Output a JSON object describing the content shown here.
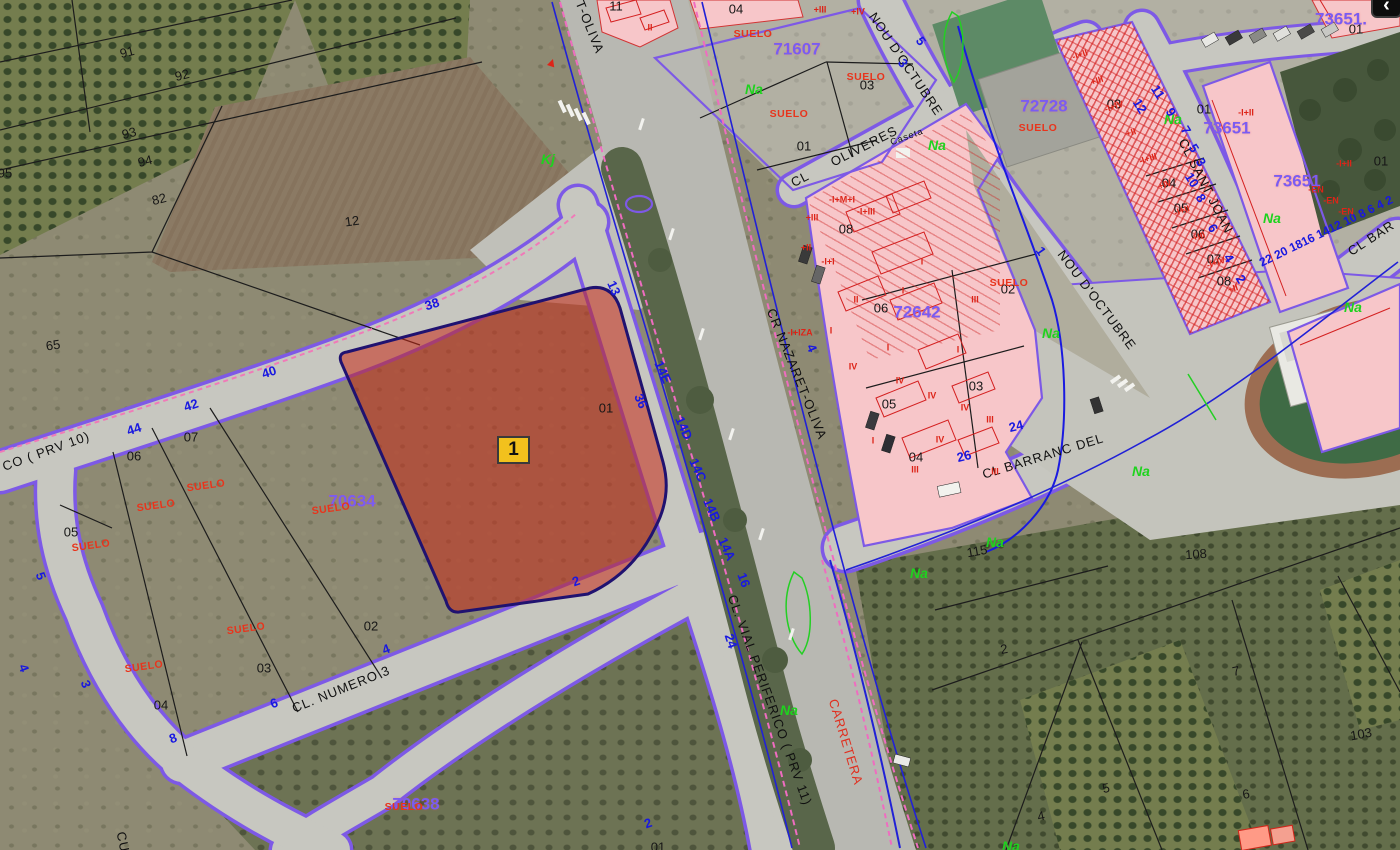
{
  "map": {
    "selected_parcel_marker": "1",
    "nav_button_glyph": "‹"
  },
  "colors": {
    "selection_fill": "#c42816",
    "selection_outline": "#201270",
    "zone_code": "#7a5cf2",
    "street_edge": "#7d59e6",
    "house_number": "#1818e0",
    "suelo": "#e8341c",
    "crop_code": "#1ed31e",
    "marker_fill": "#f2c11d"
  },
  "street_labels": [
    {
      "t": "T-OLIVA",
      "x": 590,
      "y": 27,
      "r": 68
    },
    {
      "t": "CR NAZARET-OLIVA",
      "x": 797,
      "y": 374,
      "r": 68
    },
    {
      "t": "NOU D'OCTUBRE",
      "x": 906,
      "y": 64,
      "r": 56
    },
    {
      "t": "NOU D'OCTUBRE",
      "x": 1097,
      "y": 300,
      "r": 53
    },
    {
      "t": "CL",
      "x": 800,
      "y": 179,
      "r": -27
    },
    {
      "t": "OLIVERES",
      "x": 864,
      "y": 146,
      "r": -27
    },
    {
      "t": "Caseta",
      "x": 907,
      "y": 137,
      "r": -20,
      "s": 9
    },
    {
      "t": "CL SANT JOAN",
      "x": 1206,
      "y": 186,
      "r": 63
    },
    {
      "t": "CL BARRANC DEL",
      "x": 1043,
      "y": 456,
      "r": -17
    },
    {
      "t": "CL BAR",
      "x": 1371,
      "y": 238,
      "r": -33
    },
    {
      "t": "CL. NUMERO 3",
      "x": 341,
      "y": 689,
      "r": -22
    },
    {
      "t": "CL. VIAL PERIFERICO ( PRV 11)",
      "x": 770,
      "y": 700,
      "r": 70
    },
    {
      "t": "CO ( PRV 10)",
      "x": 46,
      "y": 451,
      "r": -20
    },
    {
      "t": "CARRETERA",
      "x": 846,
      "y": 742,
      "r": 73,
      "c": "red"
    },
    {
      "t": "CU",
      "x": 123,
      "y": 842,
      "r": 78
    }
  ],
  "parcel_numbers": [
    {
      "t": "91",
      "x": 127,
      "y": 52,
      "r": -14
    },
    {
      "t": "92",
      "x": 182,
      "y": 75,
      "r": -14
    },
    {
      "t": "93",
      "x": 129,
      "y": 133,
      "r": -14
    },
    {
      "t": "94",
      "x": 145,
      "y": 161,
      "r": -14
    },
    {
      "t": "82",
      "x": 159,
      "y": 199,
      "r": -14
    },
    {
      "t": "12",
      "x": 352,
      "y": 221,
      "r": -8
    },
    {
      "t": "95",
      "x": 5,
      "y": 173
    },
    {
      "t": "65",
      "x": 53,
      "y": 345,
      "r": -8
    },
    {
      "t": "07",
      "x": 191,
      "y": 437
    },
    {
      "t": "06",
      "x": 134,
      "y": 456
    },
    {
      "t": "05",
      "x": 71,
      "y": 532
    },
    {
      "t": "02",
      "x": 371,
      "y": 626
    },
    {
      "t": "03",
      "x": 264,
      "y": 668
    },
    {
      "t": "04",
      "x": 161,
      "y": 705
    },
    {
      "t": "04",
      "x": 736,
      "y": 9
    },
    {
      "t": "11",
      "x": 616,
      "y": 6
    },
    {
      "t": "03",
      "x": 867,
      "y": 85
    },
    {
      "t": "01",
      "x": 804,
      "y": 146
    },
    {
      "t": "08",
      "x": 846,
      "y": 229
    },
    {
      "t": "06",
      "x": 881,
      "y": 308
    },
    {
      "t": "02",
      "x": 1008,
      "y": 289
    },
    {
      "t": "05",
      "x": 889,
      "y": 404
    },
    {
      "t": "03",
      "x": 976,
      "y": 386
    },
    {
      "t": "04",
      "x": 916,
      "y": 457
    },
    {
      "t": "03",
      "x": 1114,
      "y": 104
    },
    {
      "t": "01",
      "x": 1204,
      "y": 109
    },
    {
      "t": "04",
      "x": 1169,
      "y": 183
    },
    {
      "t": "05",
      "x": 1181,
      "y": 208
    },
    {
      "t": "06",
      "x": 1198,
      "y": 234
    },
    {
      "t": "07",
      "x": 1214,
      "y": 259
    },
    {
      "t": "08",
      "x": 1224,
      "y": 281
    },
    {
      "t": "01",
      "x": 1356,
      "y": 29
    },
    {
      "t": "01",
      "x": 1381,
      "y": 161
    },
    {
      "t": "01",
      "x": 606,
      "y": 408
    },
    {
      "t": "2",
      "x": 1004,
      "y": 649,
      "r": -10
    },
    {
      "t": "7",
      "x": 1236,
      "y": 671,
      "r": -12
    },
    {
      "t": "103",
      "x": 1361,
      "y": 734,
      "r": -10
    },
    {
      "t": "5",
      "x": 1106,
      "y": 788,
      "r": -12
    },
    {
      "t": "6",
      "x": 1246,
      "y": 794,
      "r": -10
    },
    {
      "t": "4",
      "x": 1041,
      "y": 816,
      "r": -12
    },
    {
      "t": "115",
      "x": 977,
      "y": 551,
      "r": -10
    },
    {
      "t": "108",
      "x": 1196,
      "y": 554,
      "r": -4
    },
    {
      "t": "01",
      "x": 658,
      "y": 847
    }
  ],
  "zone_codes": [
    {
      "t": "71607",
      "x": 797,
      "y": 49
    },
    {
      "t": "72728",
      "x": 1044,
      "y": 106
    },
    {
      "t": "73651",
      "x": 1227,
      "y": 128
    },
    {
      "t": "73651",
      "x": 1297,
      "y": 181
    },
    {
      "t": "73651.",
      "x": 1341,
      "y": 19
    },
    {
      "t": "72642",
      "x": 917,
      "y": 312
    },
    {
      "t": "70634",
      "x": 352,
      "y": 501
    },
    {
      "t": "70638",
      "x": 416,
      "y": 804
    }
  ],
  "suelo_labels": [
    {
      "t": "SUELO",
      "x": 753,
      "y": 34
    },
    {
      "t": "SUELO",
      "x": 866,
      "y": 77
    },
    {
      "t": "SUELO",
      "x": 789,
      "y": 114
    },
    {
      "t": "SUELO",
      "x": 1038,
      "y": 128
    },
    {
      "t": "SUELO",
      "x": 1009,
      "y": 283
    },
    {
      "t": "SUELO",
      "x": 206,
      "y": 486,
      "r": -8
    },
    {
      "t": "SUELO",
      "x": 156,
      "y": 506,
      "r": -8
    },
    {
      "t": "SUELO",
      "x": 91,
      "y": 546,
      "r": -8
    },
    {
      "t": "SUELO",
      "x": 331,
      "y": 509,
      "r": -8
    },
    {
      "t": "SUELO",
      "x": 144,
      "y": 667,
      "r": -8
    },
    {
      "t": "SUELO",
      "x": 246,
      "y": 629,
      "r": -8
    },
    {
      "t": "SUELO",
      "x": 404,
      "y": 807
    }
  ],
  "na_labels": [
    {
      "t": "Na",
      "x": 754,
      "y": 89
    },
    {
      "t": "Na",
      "x": 1173,
      "y": 119
    },
    {
      "t": "Na",
      "x": 1272,
      "y": 218
    },
    {
      "t": "Na",
      "x": 1353,
      "y": 307
    },
    {
      "t": "Na",
      "x": 1051,
      "y": 333
    },
    {
      "t": "Na",
      "x": 1141,
      "y": 471
    },
    {
      "t": "Na",
      "x": 995,
      "y": 542
    },
    {
      "t": "Na",
      "x": 919,
      "y": 573
    },
    {
      "t": "Na",
      "x": 789,
      "y": 710
    },
    {
      "t": "Na",
      "x": 1011,
      "y": 846
    },
    {
      "t": "Na",
      "x": 937,
      "y": 145
    },
    {
      "t": "Kj",
      "x": 548,
      "y": 159
    }
  ],
  "house_numbers": [
    {
      "t": "38",
      "x": 432,
      "y": 304,
      "r": -18
    },
    {
      "t": "40",
      "x": 269,
      "y": 372,
      "r": -18
    },
    {
      "t": "42",
      "x": 191,
      "y": 405,
      "r": -18
    },
    {
      "t": "44",
      "x": 134,
      "y": 429,
      "r": -18
    },
    {
      "t": "13",
      "x": 614,
      "y": 288,
      "r": 66
    },
    {
      "t": "36",
      "x": 641,
      "y": 401,
      "r": 66
    },
    {
      "t": "14E",
      "x": 663,
      "y": 372,
      "r": 66
    },
    {
      "t": "14D",
      "x": 684,
      "y": 428,
      "r": 66
    },
    {
      "t": "14C",
      "x": 698,
      "y": 470,
      "r": 66
    },
    {
      "t": "14B",
      "x": 712,
      "y": 510,
      "r": 66
    },
    {
      "t": "14A",
      "x": 727,
      "y": 549,
      "r": 66
    },
    {
      "t": "5",
      "x": 41,
      "y": 576,
      "r": 70
    },
    {
      "t": "4",
      "x": 24,
      "y": 668,
      "r": 70
    },
    {
      "t": "3",
      "x": 86,
      "y": 684,
      "r": 70
    },
    {
      "t": "6",
      "x": 274,
      "y": 703,
      "r": -20
    },
    {
      "t": "8",
      "x": 173,
      "y": 738,
      "r": -20
    },
    {
      "t": "4",
      "x": 386,
      "y": 649,
      "r": -20
    },
    {
      "t": "2",
      "x": 576,
      "y": 581,
      "r": -20
    },
    {
      "t": "24",
      "x": 731,
      "y": 641,
      "r": 72
    },
    {
      "t": "16",
      "x": 744,
      "y": 580,
      "r": 70
    },
    {
      "t": "24",
      "x": 1016,
      "y": 426,
      "r": -14
    },
    {
      "t": "26",
      "x": 964,
      "y": 456,
      "r": -14
    },
    {
      "t": "12",
      "x": 1140,
      "y": 106,
      "r": 58
    },
    {
      "t": "11",
      "x": 1158,
      "y": 92,
      "r": 58
    },
    {
      "t": "9",
      "x": 1171,
      "y": 112,
      "r": 58
    },
    {
      "t": "7",
      "x": 1186,
      "y": 130,
      "r": 58
    },
    {
      "t": "5",
      "x": 1194,
      "y": 148,
      "r": 58
    },
    {
      "t": "3",
      "x": 1201,
      "y": 162,
      "r": 58
    },
    {
      "t": "10",
      "x": 1192,
      "y": 180,
      "r": 58
    },
    {
      "t": "8",
      "x": 1201,
      "y": 198,
      "r": 58
    },
    {
      "t": "6",
      "x": 1213,
      "y": 228,
      "r": 58
    },
    {
      "t": "4",
      "x": 1229,
      "y": 258,
      "r": 58
    },
    {
      "t": "2",
      "x": 1241,
      "y": 279,
      "r": 58
    },
    {
      "t": "5",
      "x": 921,
      "y": 41,
      "r": 55
    },
    {
      "t": "3",
      "x": 903,
      "y": 63,
      "r": 55
    },
    {
      "t": "1",
      "x": 1041,
      "y": 251,
      "r": 55
    },
    {
      "t": "4",
      "x": 812,
      "y": 348,
      "r": 66
    },
    {
      "t": "22 20 1816 1412 10 8 6 4 2",
      "x": 1326,
      "y": 231,
      "r": -26,
      "s": 12
    },
    {
      "t": "2",
      "x": 648,
      "y": 823,
      "r": -20
    }
  ],
  "building_marks": [
    {
      "t": "-I+II",
      "x": 1080,
      "y": 55,
      "r": -18
    },
    {
      "t": "+III",
      "x": 1097,
      "y": 81,
      "r": -18
    },
    {
      "t": "-I+IV",
      "x": 1114,
      "y": 107,
      "r": -18
    },
    {
      "t": "+II",
      "x": 1131,
      "y": 133,
      "r": -18
    },
    {
      "t": "-I+III",
      "x": 1148,
      "y": 159,
      "r": -18
    },
    {
      "t": "+IV",
      "x": 1165,
      "y": 185,
      "r": -18
    },
    {
      "t": "-I+II",
      "x": 1182,
      "y": 211,
      "r": -18
    },
    {
      "t": "+III",
      "x": 1199,
      "y": 237,
      "r": -18
    },
    {
      "t": "-I+IV",
      "x": 1216,
      "y": 263,
      "r": -18
    },
    {
      "t": "+II",
      "x": 1233,
      "y": 289,
      "r": -18
    },
    {
      "t": "-I+II",
      "x": 1246,
      "y": 113
    },
    {
      "t": "-I+II",
      "x": 1344,
      "y": 164
    },
    {
      "t": "-EN",
      "x": 1316,
      "y": 190
    },
    {
      "t": "-EN",
      "x": 1331,
      "y": 201
    },
    {
      "t": "-EN",
      "x": 1346,
      "y": 212
    },
    {
      "t": "I",
      "x": 903,
      "y": 291
    },
    {
      "t": "I",
      "x": 888,
      "y": 348
    },
    {
      "t": "I",
      "x": 958,
      "y": 350
    },
    {
      "t": "IV",
      "x": 853,
      "y": 367
    },
    {
      "t": "IV",
      "x": 900,
      "y": 381
    },
    {
      "t": "IV",
      "x": 932,
      "y": 396
    },
    {
      "t": "IV",
      "x": 965,
      "y": 408
    },
    {
      "t": "III",
      "x": 990,
      "y": 420
    },
    {
      "t": "IV",
      "x": 940,
      "y": 440
    },
    {
      "t": "I",
      "x": 873,
      "y": 441
    },
    {
      "t": "III",
      "x": 995,
      "y": 472
    },
    {
      "t": "III",
      "x": 915,
      "y": 470
    },
    {
      "t": "II",
      "x": 856,
      "y": 300
    },
    {
      "t": "I",
      "x": 831,
      "y": 331
    },
    {
      "t": "III",
      "x": 975,
      "y": 300
    },
    {
      "t": "I",
      "x": 922,
      "y": 262
    },
    {
      "t": "-I+M+I",
      "x": 842,
      "y": 200
    },
    {
      "t": "+III",
      "x": 812,
      "y": 218
    },
    {
      "t": "-I+III",
      "x": 866,
      "y": 212
    },
    {
      "t": "+II",
      "x": 806,
      "y": 248
    },
    {
      "t": "-I+I",
      "x": 828,
      "y": 262
    },
    {
      "t": "-I+IZA",
      "x": 800,
      "y": 333
    },
    {
      "t": "+III",
      "x": 820,
      "y": 10
    },
    {
      "t": "+IV",
      "x": 858,
      "y": 12
    },
    {
      "t": "II",
      "x": 650,
      "y": 28
    },
    {
      "t": "▲",
      "x": 552,
      "y": 62,
      "r": 18,
      "s": 13
    }
  ]
}
